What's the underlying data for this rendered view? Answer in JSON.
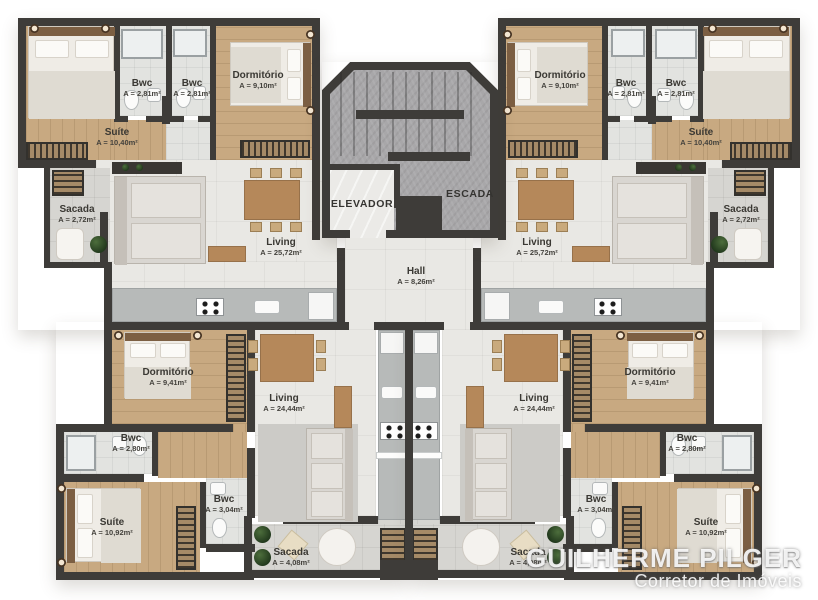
{
  "units": {
    "top_left": {
      "suite": {
        "name": "Suíte",
        "area": "A = 10,40m²"
      },
      "bwc1": {
        "name": "Bwc",
        "area": "A = 2,81m²"
      },
      "bwc2": {
        "name": "Bwc",
        "area": "A = 2,81m²"
      },
      "dorm": {
        "name": "Dormitório",
        "area": "A = 9,10m²"
      },
      "sacada": {
        "name": "Sacada",
        "area": "A = 2,72m²"
      },
      "living": {
        "name": "Living",
        "area": "A = 25,72m²"
      }
    },
    "top_right": {
      "dorm": {
        "name": "Dormitório",
        "area": "A = 9,10m²"
      },
      "bwc1": {
        "name": "Bwc",
        "area": "A = 2,81m²"
      },
      "bwc2": {
        "name": "Bwc",
        "area": "A = 2,81m²"
      },
      "suite": {
        "name": "Suíte",
        "area": "A = 10,40m²"
      },
      "sacada": {
        "name": "Sacada",
        "area": "A = 2,72m²"
      },
      "living": {
        "name": "Living",
        "area": "A = 25,72m²"
      }
    },
    "bottom_left": {
      "dorm": {
        "name": "Dormitório",
        "area": "A = 9,41m²"
      },
      "living": {
        "name": "Living",
        "area": "A = 24,44m²"
      },
      "bwc1": {
        "name": "Bwc",
        "area": "A = 2,80m²"
      },
      "bwc2": {
        "name": "Bwc",
        "area": "A = 3,04m²"
      },
      "suite": {
        "name": "Suíte",
        "area": "A = 10,92m²"
      },
      "sacada": {
        "name": "Sacada",
        "area": "A = 4,08m²"
      }
    },
    "bottom_right": {
      "dorm": {
        "name": "Dormitório",
        "area": "A = 9,41m²"
      },
      "living": {
        "name": "Living",
        "area": "A = 24,44m²"
      },
      "bwc1": {
        "name": "Bwc",
        "area": "A = 2,80m²"
      },
      "bwc2": {
        "name": "Bwc",
        "area": "A = 3,04m²"
      },
      "suite": {
        "name": "Suíte",
        "area": "A = 10,92m²"
      },
      "sacada": {
        "name": "Sacada",
        "area": "A = 4,08m²"
      }
    }
  },
  "core": {
    "elevator": {
      "name": "ELEVADOR"
    },
    "stairs": {
      "name": "ESCADA"
    },
    "hall": {
      "name": "Hall",
      "area": "A = 8,26m²"
    }
  },
  "watermark": {
    "line1": "GUILHERME PILGER",
    "line2": "Corretor de Imóveis"
  },
  "palette": {
    "wall": "#3e3c39",
    "wood_floor": "#c8a981",
    "tile_floor": "#e9e8e4",
    "balcony_floor": "#d6d5d1",
    "concrete_core": "#a8a7a9",
    "kitchen_counter": "#b7bab9",
    "plant_green": "#2f4a26",
    "watermark_white": "#ffffff"
  }
}
